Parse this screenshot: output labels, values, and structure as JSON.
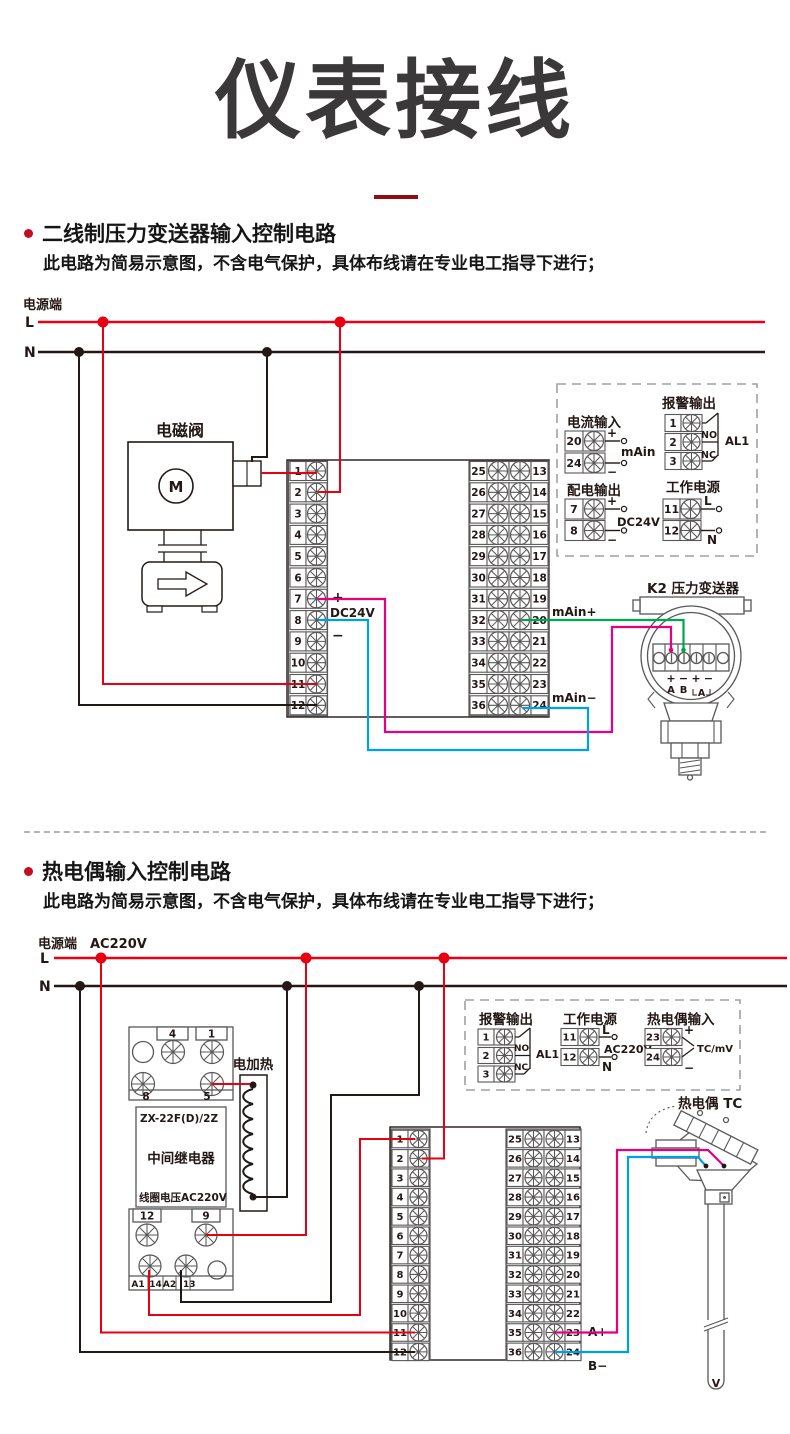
{
  "page": {
    "title": "仪表接线"
  },
  "shared": {
    "power_terminal": "电源端",
    "live": "L",
    "neutral": "N",
    "plus": "+",
    "minus": "−",
    "dc24v": "DC24V",
    "ac220v": "AC220V",
    "alarm_output": "报警输出",
    "working_power": "工作电源",
    "al1": "AL1",
    "no": "NO",
    "nc": "NC",
    "terminal_numbers": {
      "left": [
        "1",
        "2",
        "3",
        "4",
        "5",
        "6",
        "7",
        "8",
        "9",
        "10",
        "11",
        "12"
      ],
      "mid": [
        "25",
        "26",
        "27",
        "28",
        "29",
        "30",
        "31",
        "32",
        "33",
        "34",
        "35",
        "36"
      ],
      "right": [
        "13",
        "14",
        "15",
        "16",
        "17",
        "18",
        "19",
        "20",
        "21",
        "22",
        "23",
        "24"
      ]
    }
  },
  "section1": {
    "heading": "二线制压力变送器输入控制电路",
    "note": "此电路为简易示意图，不含电气保护，具体布线请在专业电工指导下进行；",
    "solenoid_valve": "电磁阀",
    "motor": "M",
    "main_in_plus": "mAin+",
    "main_in_minus": "mAin−",
    "panel": {
      "current_input": {
        "title": "电流输入",
        "terminals": [
          "20",
          "24"
        ],
        "label": "mAin"
      },
      "alarm": {
        "terminals": [
          "1",
          "2",
          "3"
        ]
      },
      "dist_output": {
        "title": "配电输出",
        "terminals": [
          "7",
          "8"
        ],
        "label": "DC24V"
      },
      "work": {
        "terminals": [
          "11",
          "12"
        ]
      }
    },
    "transmitter": {
      "title": "K2 压力变送器",
      "polarity": [
        "+",
        "−",
        "+",
        "−"
      ],
      "ports": [
        "A",
        "B",
        "A"
      ]
    }
  },
  "section2": {
    "heading": "热电偶输入控制电路",
    "note": "此电路为简易示意图，不含电气保护，具体布线请在专业电工指导下进行；",
    "relay": {
      "model": "ZX-22F(D)/2Z",
      "name": "中间继电器",
      "coil": "线圈电压AC220V",
      "top": [
        "4",
        "1"
      ],
      "mid": [
        "8",
        "5"
      ],
      "bottom": [
        "12",
        "9"
      ],
      "pads": [
        "A1",
        "14",
        "A2",
        "13"
      ]
    },
    "heater": "电加热",
    "a_plus": "A+",
    "b_minus": "B−",
    "panel": {
      "alarm": {
        "terminals": [
          "1",
          "2",
          "3"
        ]
      },
      "work": {
        "terminals": [
          "11",
          "12"
        ]
      },
      "tc_input": {
        "title": "热电偶输入",
        "terminals": [
          "23",
          "24"
        ],
        "label": "TC/mV"
      }
    },
    "tc": {
      "title": "热电偶 TC",
      "tip": "V"
    }
  },
  "colors": {
    "accent_red": "#e60012",
    "wire_black": "#231815",
    "wire_magenta": "#e4007f",
    "wire_blue": "#00a0e9",
    "wire_green": "#00a551",
    "dark_red": "#8e0c12"
  }
}
